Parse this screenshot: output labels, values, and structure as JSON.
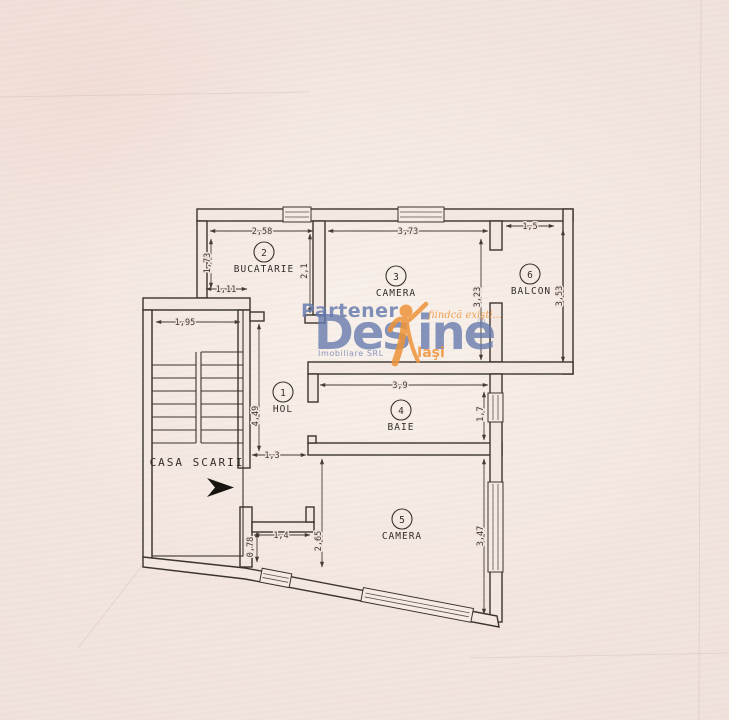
{
  "watermark": {
    "partener": "Partener",
    "brand_left": "Des",
    "brand_right": "ine",
    "registered": "®",
    "subtitle": "Imobiliare SRL",
    "city": "Iaşi",
    "tagline": "fiindcă exişti...",
    "colors": {
      "blue": "#6479ae",
      "orange": "#ee9338"
    }
  },
  "stairwell": {
    "label": "CASA SCARII"
  },
  "rooms": [
    {
      "number": "1",
      "name": "HOL"
    },
    {
      "number": "2",
      "name": "BUCATARIE"
    },
    {
      "number": "3",
      "name": "CAMERA"
    },
    {
      "number": "4",
      "name": "BAIE"
    },
    {
      "number": "5",
      "name": "CAMERA"
    },
    {
      "number": "6",
      "name": "BALCON"
    }
  ],
  "dims": {
    "kitchen_top": "2,58",
    "kitchen_left": "1,73",
    "kitchen_door": "1,11",
    "kitchen_right": "2,1",
    "room3_top": "3,73",
    "room3_right": "3,23",
    "balcony_top": "1,5",
    "balcony_right": "3,53",
    "stairs_width": "1,95",
    "hall_height": "4,49",
    "bath_top": "3,9",
    "bath_right": "1,7",
    "hall_width": "1,3",
    "room5_left": "2,65",
    "niche_width": "1,4",
    "niche_depth": "0,78",
    "room5_right": "3,47"
  }
}
